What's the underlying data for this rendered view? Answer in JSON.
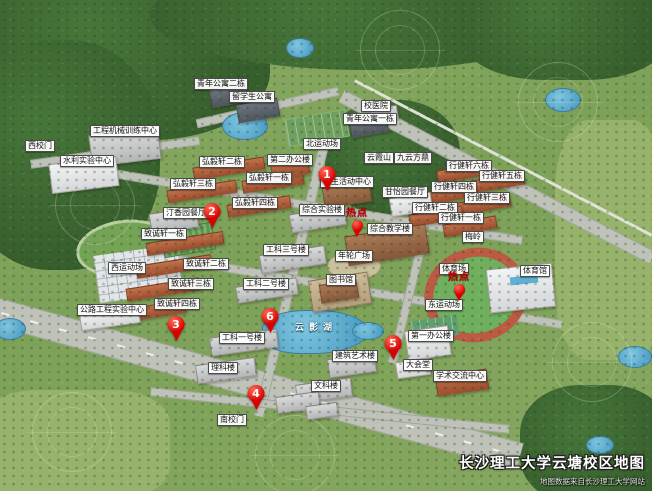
{
  "map": {
    "title": "长沙理工大学云塘校区地图",
    "attribution": "地图数据来自长沙理工大学网站",
    "hotspot_text": "热点",
    "colors": {
      "marker_red": "#d90000",
      "hotspot_text_red": "#bb0000",
      "label_bg": "#ffffff",
      "label_text": "#111111",
      "title_white": "#ffffff",
      "grass_green": "#7da158",
      "forest_green": "#3c6733",
      "road_gray": "#bec2b8",
      "water_blue": "#5fb0d5",
      "track_red": "#bc5a44"
    },
    "building_labels": [
      {
        "text": "西校门",
        "x": 40,
        "y": 146
      },
      {
        "text": "工程机械训练中心",
        "x": 125,
        "y": 131
      },
      {
        "text": "水利实验中心",
        "x": 87,
        "y": 161
      },
      {
        "text": "青年公寓二栋",
        "x": 221,
        "y": 84
      },
      {
        "text": "留学生公寓",
        "x": 252,
        "y": 97
      },
      {
        "text": "校医院",
        "x": 376,
        "y": 106
      },
      {
        "text": "青年公寓一栋",
        "x": 370,
        "y": 119
      },
      {
        "text": "北运动场",
        "x": 322,
        "y": 144
      },
      {
        "text": "第二办公楼",
        "x": 290,
        "y": 160
      },
      {
        "text": "云霞山",
        "x": 379,
        "y": 158
      },
      {
        "text": "九云方鼎",
        "x": 413,
        "y": 158
      },
      {
        "text": "学生活动中心",
        "x": 347,
        "y": 182
      },
      {
        "text": "弘毅轩二栋",
        "x": 222,
        "y": 162
      },
      {
        "text": "弘毅轩一栋",
        "x": 269,
        "y": 178
      },
      {
        "text": "弘毅轩三栋",
        "x": 193,
        "y": 184
      },
      {
        "text": "弘毅轩四栋",
        "x": 255,
        "y": 203
      },
      {
        "text": "汀香园餐厅",
        "x": 186,
        "y": 213
      },
      {
        "text": "甘怡园餐厅",
        "x": 405,
        "y": 192
      },
      {
        "text": "行健轩六栋",
        "x": 469,
        "y": 166
      },
      {
        "text": "行健轩五栋",
        "x": 502,
        "y": 176
      },
      {
        "text": "行健轩四栋",
        "x": 454,
        "y": 187
      },
      {
        "text": "行健轩三栋",
        "x": 487,
        "y": 198
      },
      {
        "text": "行健轩二栋",
        "x": 435,
        "y": 208
      },
      {
        "text": "行健轩一栋",
        "x": 461,
        "y": 218
      },
      {
        "text": "综合实验楼",
        "x": 322,
        "y": 210
      },
      {
        "text": "综合教学楼",
        "x": 390,
        "y": 229
      },
      {
        "text": "梅岭",
        "x": 473,
        "y": 237
      },
      {
        "text": "体育场",
        "x": 454,
        "y": 269
      },
      {
        "text": "体育馆",
        "x": 535,
        "y": 271
      },
      {
        "text": "东运动场",
        "x": 444,
        "y": 305
      },
      {
        "text": "致诚轩一栋",
        "x": 164,
        "y": 234
      },
      {
        "text": "致诚轩二栋",
        "x": 206,
        "y": 264
      },
      {
        "text": "致诚轩三栋",
        "x": 191,
        "y": 284
      },
      {
        "text": "致诚轩四栋",
        "x": 177,
        "y": 304
      },
      {
        "text": "西运动场",
        "x": 127,
        "y": 268
      },
      {
        "text": "公路工程实验中心",
        "x": 112,
        "y": 310
      },
      {
        "text": "工科三号楼",
        "x": 286,
        "y": 250
      },
      {
        "text": "年轮广场",
        "x": 354,
        "y": 256
      },
      {
        "text": "图书馆",
        "x": 341,
        "y": 280
      },
      {
        "text": "工科二号楼",
        "x": 266,
        "y": 284
      },
      {
        "text": "工科一号楼",
        "x": 242,
        "y": 338
      },
      {
        "text": "理科楼",
        "x": 223,
        "y": 368
      },
      {
        "text": "文科楼",
        "x": 326,
        "y": 386
      },
      {
        "text": "南校门",
        "x": 232,
        "y": 420
      },
      {
        "text": "第一办公楼",
        "x": 431,
        "y": 336
      },
      {
        "text": "建筑艺术楼",
        "x": 355,
        "y": 356
      },
      {
        "text": "大会堂",
        "x": 418,
        "y": 365
      },
      {
        "text": "学术交流中心",
        "x": 460,
        "y": 376
      },
      {
        "text": "云影湖",
        "x": 316,
        "y": 328,
        "variant": "lake"
      }
    ],
    "numbered_markers": [
      {
        "number": "1",
        "x": 327,
        "y": 191
      },
      {
        "number": "2",
        "x": 212,
        "y": 228
      },
      {
        "number": "3",
        "x": 176,
        "y": 341
      },
      {
        "number": "4",
        "x": 256,
        "y": 410
      },
      {
        "number": "5",
        "x": 393,
        "y": 360
      },
      {
        "number": "6",
        "x": 270,
        "y": 333
      }
    ],
    "hotspot_markers": [
      {
        "x": 357,
        "y": 237
      },
      {
        "x": 459,
        "y": 301
      }
    ]
  }
}
